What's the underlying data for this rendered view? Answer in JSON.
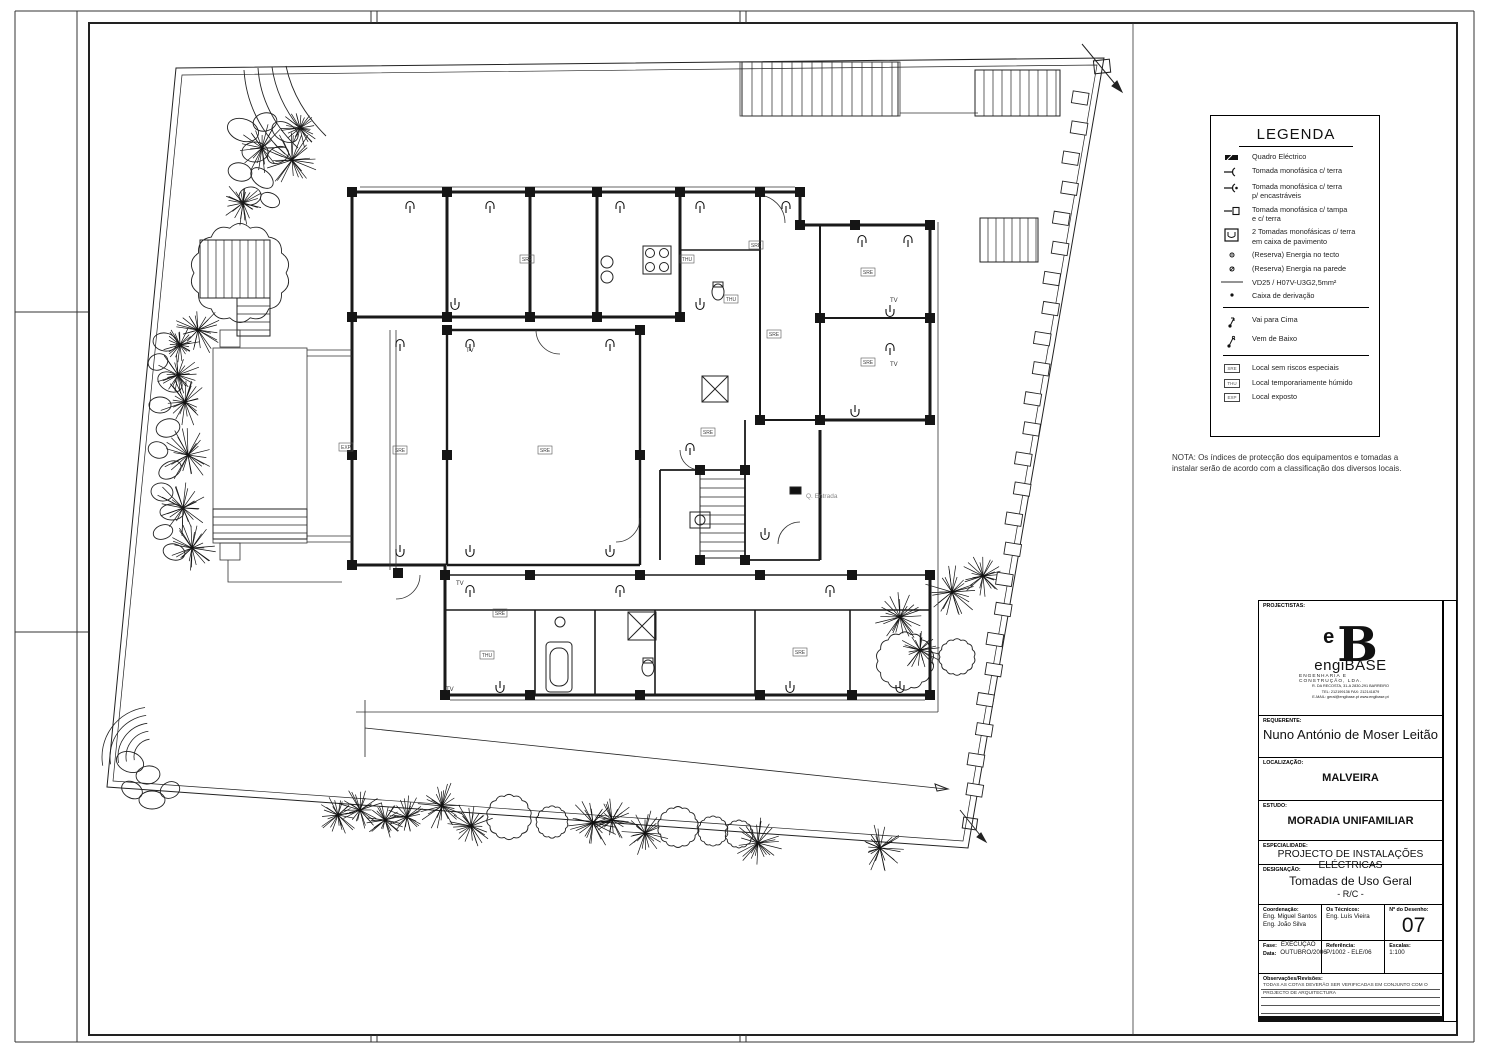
{
  "legend": {
    "title": "LEGENDA",
    "items": [
      {
        "label": "Quadro Eléctrico"
      },
      {
        "label": "Tomada monofásica c/ terra"
      },
      {
        "label": "Tomada monofásica c/ terra",
        "label2": "p/ encastráveis"
      },
      {
        "label": "Tomada monofásica c/ tampa",
        "label2": "e c/ terra"
      },
      {
        "label": "2 Tomadas monofásicas c/ terra",
        "label2": "em caixa de pavimento"
      },
      {
        "label": "(Reserva) Energia no tecto"
      },
      {
        "label": "(Reserva) Energia na parede"
      },
      {
        "label": "VD25 / H07V-U3G2,5mm²"
      },
      {
        "label": "Caixa de derivação"
      },
      {
        "label": "Vai para Cima"
      },
      {
        "label": "Vem de Baixo"
      },
      {
        "code": "SRE",
        "label": "Local sem riscos especiais"
      },
      {
        "code": "THU",
        "label": "Local temporariamente húmido"
      },
      {
        "code": "EXP",
        "label": "Local exposto"
      }
    ]
  },
  "nota": {
    "line1": "NOTA: Os índices de protecção dos equipamentos e tomadas a",
    "line2": "instalar serão de acordo com a classificação dos diversos locais."
  },
  "plan": {
    "tv": "TV",
    "entrada": "Q. Entrada",
    "room_labels": [
      "SRE",
      "THU",
      "SRE",
      "THU",
      "SRE",
      "SRE",
      "SRE",
      "SRE",
      "SRE",
      "SRE",
      "EXP",
      "SRE",
      "THU",
      "SRE"
    ]
  },
  "title_block": {
    "projectistas_label": "PROJECTISTAS:",
    "logo_e": "e",
    "logo_b": "B",
    "logo_name": "engiBASE",
    "logo_sub1": "ENGENHARIA E",
    "logo_sub2": "CONSTRUÇÃO, LDA.",
    "addr1": "R. DA RECOSTA, 31-A 2830-291 BARREIRO",
    "addr2": "TEL: 212199136 FAX: 212141879",
    "addr3": "E-MAIL: geral@engibase.pt  www.engibase.pt",
    "requerente_label": "REQUERENTE:",
    "requerente": "Nuno António de Moser Leitão",
    "localizacao_label": "LOCALIZAÇÃO:",
    "localizacao": "MALVEIRA",
    "estudo_label": "ESTUDO:",
    "estudo": "MORADIA UNIFAMILIAR",
    "especialidade_label": "ESPECIALIDADE:",
    "especialidade": "PROJECTO DE INSTALAÇÕES ELÉCTRICAS",
    "designacao_label": "DESIGNAÇÃO:",
    "designacao": "Tomadas de Uso Geral",
    "designacao2": "- R/C -",
    "coordenacao_label": "Coordenação:",
    "coordenacao1": "Eng. Miguel Santos",
    "coordenacao2": "Eng. João Silva",
    "tecnicos_label": "Os Técnicos:",
    "tecnicos": "Eng. Luís Vieira",
    "desenho_label": "Nº do Desenho:",
    "desenho": "07",
    "fase_label": "Fase:",
    "fase": "EXECUÇÃO",
    "data_label": "Data:",
    "data": "OUTUBRO/2006",
    "referencia_label": "Referência:",
    "referencia": "P/1002 - ELE/06",
    "escalas_label": "Escalas:",
    "escalas": "1:100",
    "observacoes_label": "Observações/Revisões:",
    "observacoes1": "TODAS AS COTAS DEVERÃO SER VERIFICADAS EM CONJUNTO COM O",
    "observacoes2": "PROJECTO DE ARQUITECTURA",
    "strip_note": "ESTE DESENHO É PROPRIEDADE DOS AUTORES E NÃO PODERÁ SER REPRODUZIDO OU CEDIDO SEM A AUTORIZAÇÃO PRÉVIA DOS MESMOS - TODOS OS DIREITOS RESERVADOS"
  }
}
